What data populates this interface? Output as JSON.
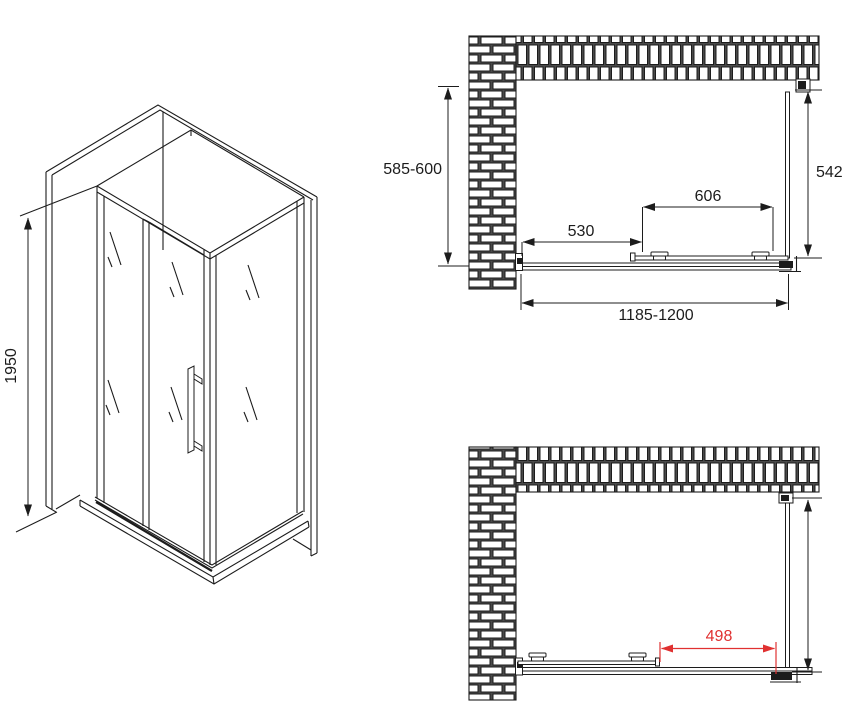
{
  "drawing": {
    "title": "shower-enclosure-dimension-drawing",
    "background": "#ffffff",
    "line_color": "#1c1c1c",
    "accent_red": "#e03131",
    "iso_view": {
      "height_label": "1950"
    },
    "top_view": {
      "wall_depth_label": "585-600",
      "side_glass_label": "542",
      "door_width_label": "606",
      "fixed_panel_label": "530",
      "total_width_label": "1185-1200"
    },
    "bottom_view": {
      "opening_width_label": "498"
    }
  }
}
